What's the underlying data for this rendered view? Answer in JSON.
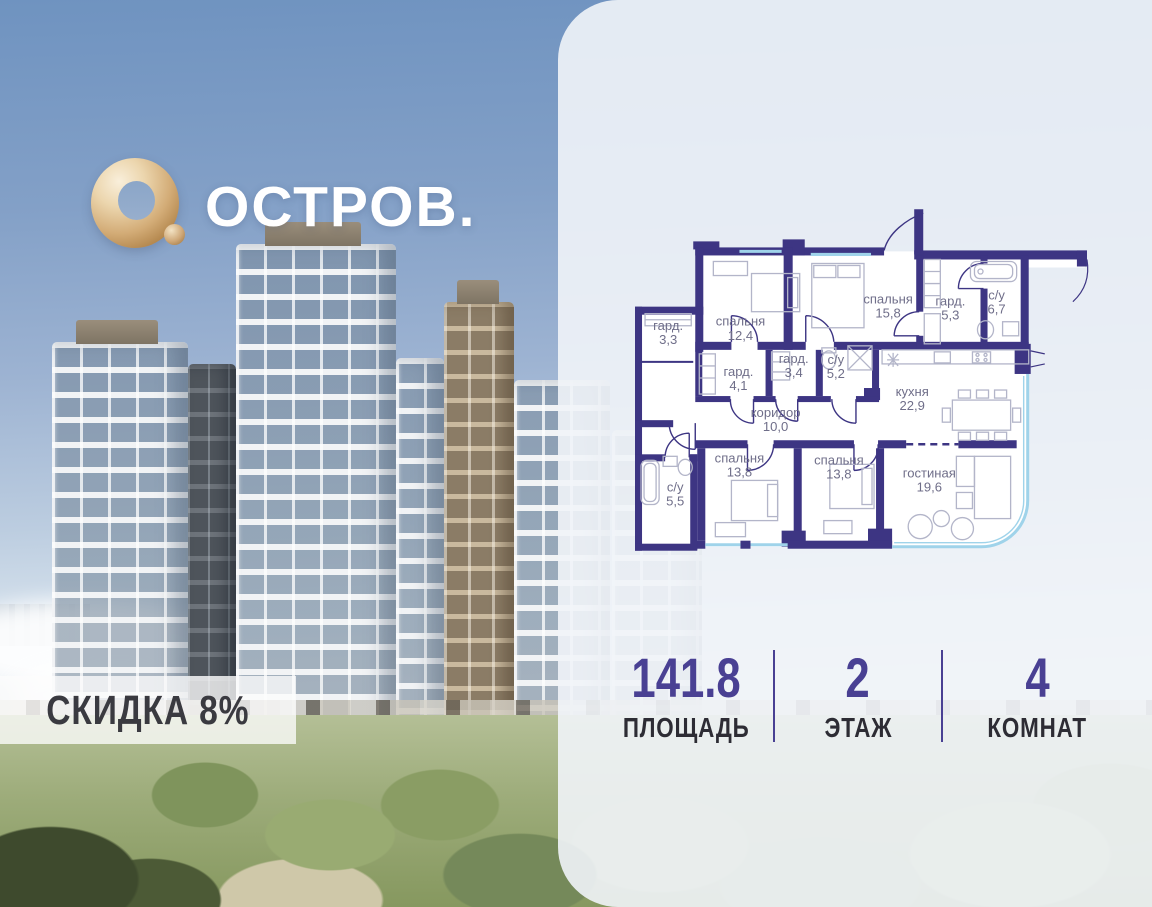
{
  "brand": {
    "name": "ОСТРОВ."
  },
  "discount": {
    "label": "СКИДКА 8%"
  },
  "floorplan": {
    "rooms": [
      {
        "name": "гард.",
        "area": "3,3"
      },
      {
        "name": "спальня",
        "area": "12,4"
      },
      {
        "name": "спальня",
        "area": "15,8"
      },
      {
        "name": "гард.",
        "area": "5,3"
      },
      {
        "name": "с/у",
        "area": "6,7"
      },
      {
        "name": "гард.",
        "area": "4,1"
      },
      {
        "name": "гард.",
        "area": "3,4"
      },
      {
        "name": "с/у",
        "area": "5,2"
      },
      {
        "name": "кухня",
        "area": "22,9"
      },
      {
        "name": "коридор",
        "area": "10,0"
      },
      {
        "name": "с/у",
        "area": "5,5"
      },
      {
        "name": "спальня",
        "area": "13,8"
      },
      {
        "name": "спальня",
        "area": "13,8"
      },
      {
        "name": "гостиная",
        "area": "19,6"
      }
    ]
  },
  "stats": {
    "items": [
      {
        "value": "141.8",
        "label": "ПЛОЩАДЬ"
      },
      {
        "value": "2",
        "label": "ЭТАЖ"
      },
      {
        "value": "4",
        "label": "КОМНАТ"
      }
    ]
  },
  "colors": {
    "wall": "#3d3583",
    "accent": "#494093",
    "gold": "#c8a371",
    "window": "#9fd3ea"
  }
}
